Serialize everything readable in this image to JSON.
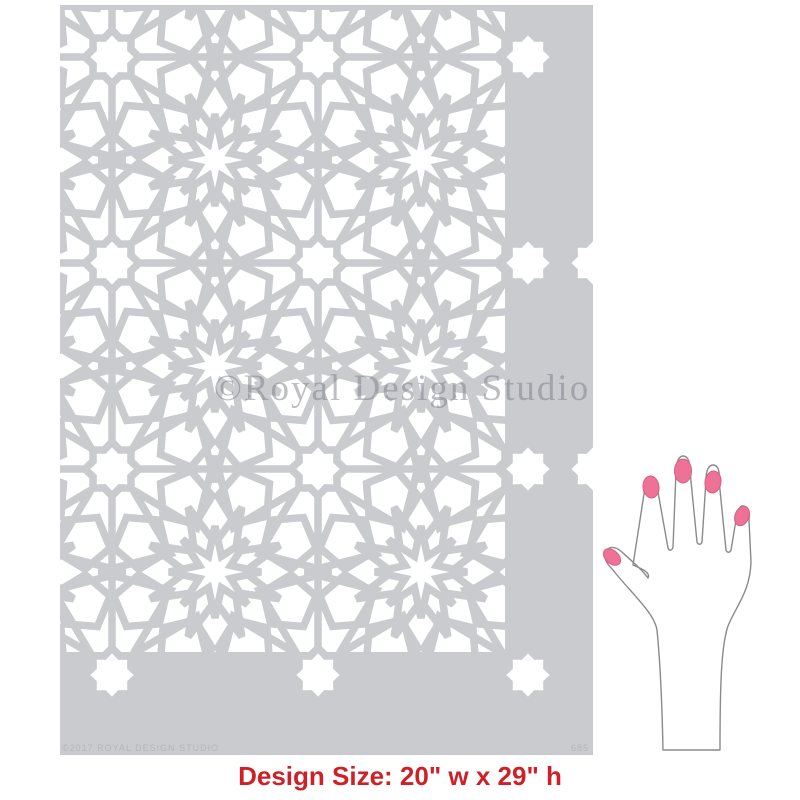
{
  "artwork": {
    "sheet_color": "#c9cbce",
    "cutout_color": "#ffffff",
    "pattern_icon": "moroccan-eight-point-star-lattice",
    "watermark": "©Royal Design Studio",
    "copyright_line": "©2017 ROYAL DESIGN STUDIO",
    "product_code": "685"
  },
  "scale_reference": {
    "icon": "hand-with-pink-nails",
    "nail_color": "#ee7296",
    "outline_color": "#8a8a8a"
  },
  "caption": {
    "label": "Design Size:",
    "value": "20\" w x 29\" h",
    "color": "#cf2027"
  }
}
